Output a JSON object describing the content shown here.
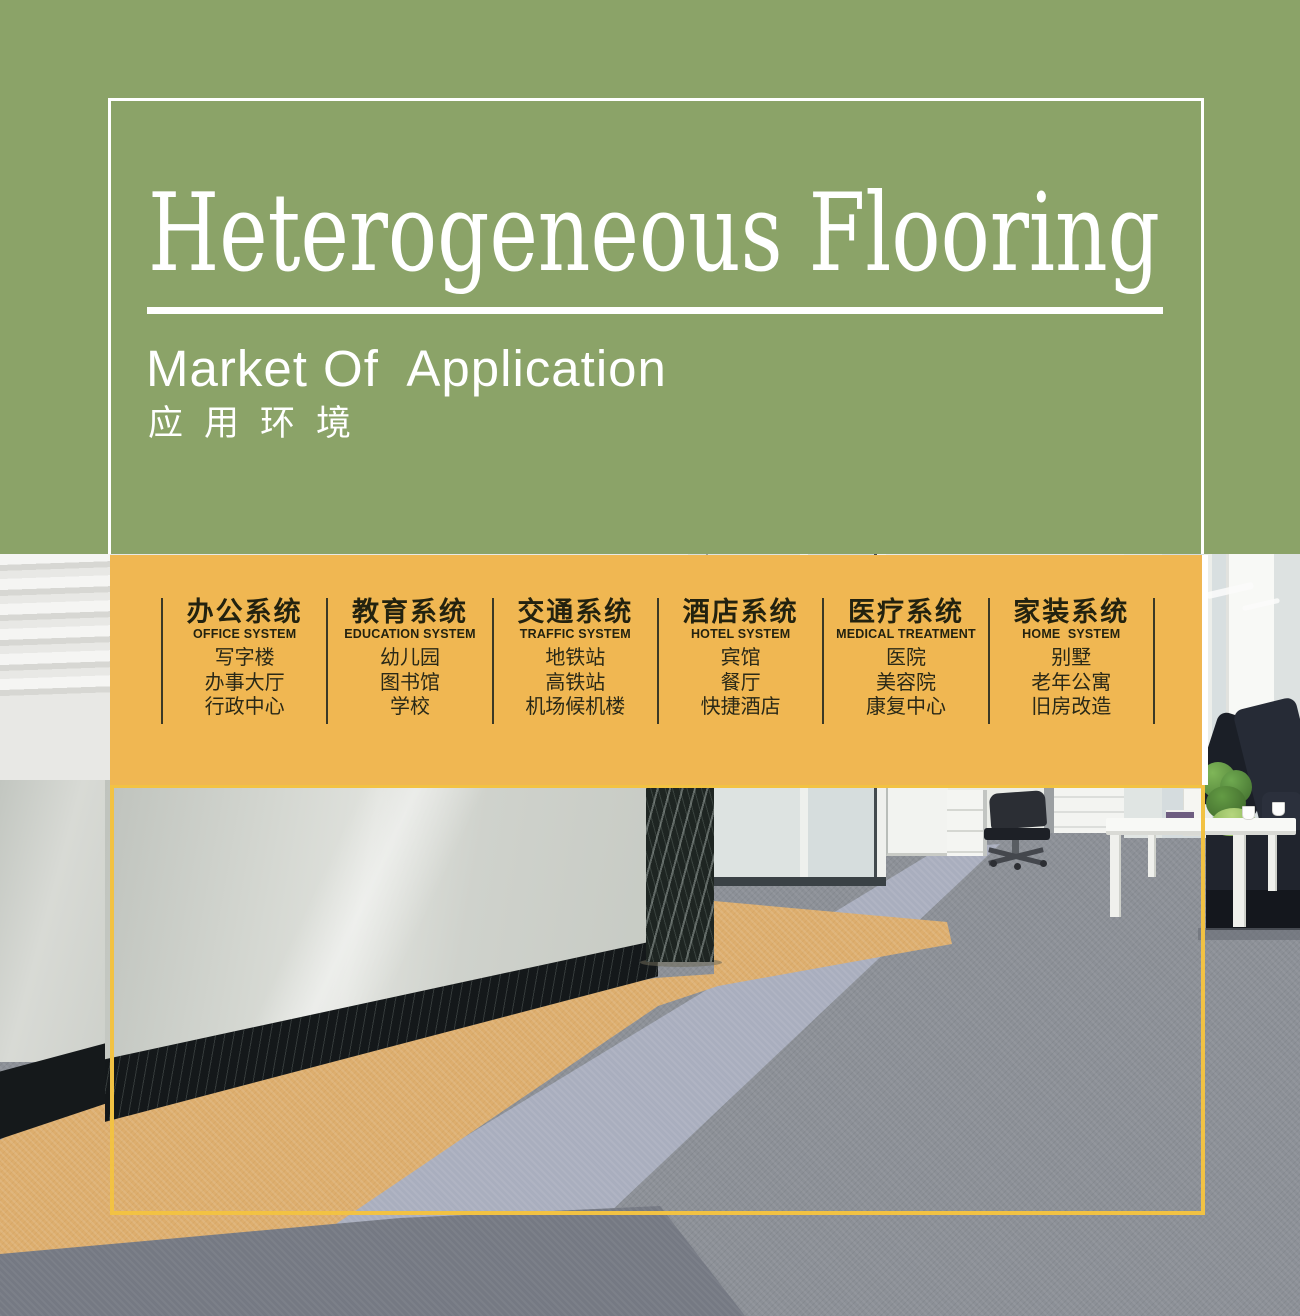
{
  "header": {
    "title": "Heterogeneous Flooring",
    "subtitle_en": "Market Of  Application",
    "subtitle_zh": "应用环境"
  },
  "categories": [
    {
      "title_zh": "办公系统",
      "title_en": "OFFICE SYSTEM",
      "items": [
        "写字楼",
        "办事大厅",
        "行政中心"
      ]
    },
    {
      "title_zh": "教育系统",
      "title_en": "EDUCATION SYSTEM",
      "items": [
        "幼儿园",
        "图书馆",
        "学校"
      ]
    },
    {
      "title_zh": "交通系统",
      "title_en": "TRAFFIC SYSTEM",
      "items": [
        "地铁站",
        "高铁站",
        "机场候机楼"
      ]
    },
    {
      "title_zh": "酒店系统",
      "title_en": "HOTEL SYSTEM",
      "items": [
        "宾馆",
        "餐厅",
        "快捷酒店"
      ]
    },
    {
      "title_zh": "医疗系统",
      "title_en": "MEDICAL TREATMENT",
      "items": [
        "医院",
        "美容院",
        "康复中心"
      ]
    },
    {
      "title_zh": "家装系统",
      "title_en": "HOME  SYSTEM",
      "items": [
        "别墅",
        "老年公寓",
        "旧房改造"
      ]
    }
  ],
  "colors": {
    "green": "#8BA368",
    "band": "#F0B752",
    "gold": "#F2C243",
    "white": "#FFFFFF",
    "ink": "#23220F",
    "tan": "#DDAE6E",
    "gray": "#8C9097",
    "lgray": "#A9AEBE",
    "dgray": "#757983"
  }
}
